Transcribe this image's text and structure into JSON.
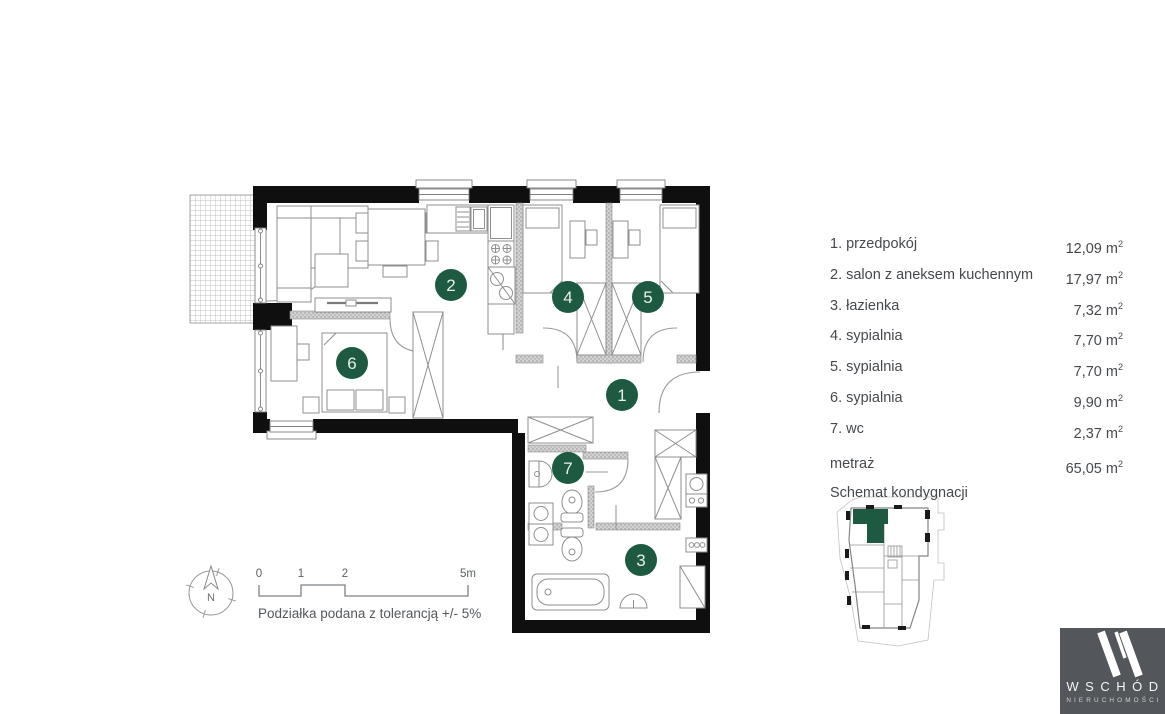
{
  "legend": {
    "items": [
      {
        "label": "1. przedpokój",
        "value": "12,09"
      },
      {
        "label": "2. salon z aneksem kuchennym",
        "value": "17,97"
      },
      {
        "label": "3. łazienka",
        "value": "7,32"
      },
      {
        "label": "4. sypialnia",
        "value": "7,70"
      },
      {
        "label": "5. sypialnia",
        "value": "7,70"
      },
      {
        "label": "6. sypialnia",
        "value": "9,90"
      },
      {
        "label": "7. wc",
        "value": "2,37"
      }
    ],
    "unit": "m",
    "sup": "2",
    "total_label": "metraż",
    "total_value": "65,05",
    "schema_label": "Schemat kondygnacji"
  },
  "plan": {
    "room_numbers": [
      "1",
      "2",
      "3",
      "4",
      "5",
      "6",
      "7"
    ]
  },
  "scale_bar": {
    "t0": "0",
    "t1": "1",
    "t2": "2",
    "t5": "5m",
    "note": "Podziałka podana z tolerancją +/- 5%"
  },
  "compass": {
    "north": "N"
  },
  "logo": {
    "name": "WSCHÓD",
    "subtitle": "NIERUCHOMOŚCI"
  },
  "colors": {
    "accent_green": "#1d5a41",
    "logo_background": "#53565a",
    "wall_black": "#0f0f0f",
    "line_gray": "#8f8f8f"
  }
}
